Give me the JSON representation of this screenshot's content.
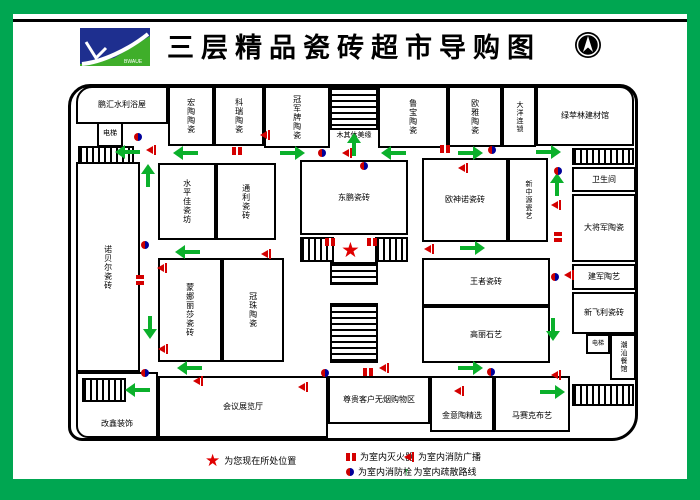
{
  "header": {
    "title": "三层精品瓷砖超市导购图",
    "logo_text": "BWAUE"
  },
  "colors": {
    "frame_green": "#00A651",
    "arrow_green": "#0BB02B",
    "marker_red": "#D40000",
    "hydrant_blue": "#000099",
    "wall_black": "#000000"
  },
  "rooms": {
    "penghui": "鹏汇水利浴屋",
    "elev1": "电梯",
    "t1": "宏陶陶瓷",
    "t2": "科瑞陶瓷",
    "t3": "冠军牌陶瓷",
    "stair_label": "木其休美缘",
    "t4": "鲁宝陶瓷",
    "t5": "欧雅陶瓷",
    "t6": "大洋连锁",
    "t7": "绿苹林建材馆",
    "toilet": "卫生间",
    "r1": "大将军陶瓷",
    "r2": "建军陶艺",
    "r3": "新飞利瓷砖",
    "elev2": "电梯",
    "chaoshan": "潮汕餐馆",
    "left_tall": "诺贝尔瓷砖",
    "m1": "水平佳瓷坊",
    "m2": "通利瓷砖",
    "center": "东鹏瓷砖",
    "rc1": "欧神诺瓷砖",
    "rc2": "新中源瓷艺",
    "bm1": "蒙娜丽莎瓷砖",
    "bm2": "冠珠陶瓷",
    "br1": "王者瓷砖",
    "br2": "高丽石艺",
    "bl": "改鑫装饰",
    "meeting": "会议展览厅",
    "b1": "尊贵客户无烟购物区",
    "b2": "金意陶精选",
    "b3": "马赛克布艺"
  },
  "legend": {
    "location": "为您现在所处位置",
    "extinguisher": "为室内灭火器",
    "hydrant": "为室内消防栓",
    "broadcast": "为室内消防广播",
    "route": "为室内疏散路线"
  },
  "markers": {
    "star": {
      "x": 341,
      "y": 240
    },
    "arrows": [
      {
        "dir": "left",
        "x": 118,
        "y": 150
      },
      {
        "dir": "left",
        "x": 176,
        "y": 151
      },
      {
        "dir": "right",
        "x": 280,
        "y": 151
      },
      {
        "dir": "left",
        "x": 384,
        "y": 151
      },
      {
        "dir": "right",
        "x": 458,
        "y": 151
      },
      {
        "dir": "right",
        "x": 536,
        "y": 150
      },
      {
        "dir": "up",
        "x": 146,
        "y": 167
      },
      {
        "dir": "up",
        "x": 352,
        "y": 136
      },
      {
        "dir": "up",
        "x": 555,
        "y": 176
      },
      {
        "dir": "down",
        "x": 551,
        "y": 318
      },
      {
        "dir": "down",
        "x": 148,
        "y": 316
      },
      {
        "dir": "left",
        "x": 178,
        "y": 250
      },
      {
        "dir": "right",
        "x": 460,
        "y": 246
      },
      {
        "dir": "left",
        "x": 180,
        "y": 366
      },
      {
        "dir": "left",
        "x": 128,
        "y": 388
      },
      {
        "dir": "right",
        "x": 458,
        "y": 366
      },
      {
        "dir": "right",
        "x": 540,
        "y": 390
      }
    ],
    "extinguishers": [
      {
        "x": 232,
        "y": 147,
        "orient": "h"
      },
      {
        "x": 440,
        "y": 145,
        "orient": "h"
      },
      {
        "x": 325,
        "y": 238,
        "orient": "h"
      },
      {
        "x": 367,
        "y": 238,
        "orient": "h"
      },
      {
        "x": 363,
        "y": 368,
        "orient": "h"
      },
      {
        "x": 553,
        "y": 233,
        "orient": "v"
      },
      {
        "x": 135,
        "y": 276,
        "orient": "v"
      }
    ],
    "hydrants": [
      {
        "x": 134,
        "y": 133
      },
      {
        "x": 318,
        "y": 149
      },
      {
        "x": 360,
        "y": 162
      },
      {
        "x": 488,
        "y": 146
      },
      {
        "x": 554,
        "y": 167
      },
      {
        "x": 141,
        "y": 241
      },
      {
        "x": 551,
        "y": 273
      },
      {
        "x": 141,
        "y": 369
      },
      {
        "x": 321,
        "y": 369
      },
      {
        "x": 487,
        "y": 368
      }
    ],
    "speakers": [
      {
        "x": 146,
        "y": 145
      },
      {
        "x": 260,
        "y": 130
      },
      {
        "x": 342,
        "y": 148
      },
      {
        "x": 458,
        "y": 163
      },
      {
        "x": 424,
        "y": 244
      },
      {
        "x": 261,
        "y": 249
      },
      {
        "x": 157,
        "y": 263
      },
      {
        "x": 158,
        "y": 344
      },
      {
        "x": 551,
        "y": 200
      },
      {
        "x": 564,
        "y": 270
      },
      {
        "x": 551,
        "y": 370
      },
      {
        "x": 193,
        "y": 376
      },
      {
        "x": 298,
        "y": 382
      },
      {
        "x": 454,
        "y": 386
      },
      {
        "x": 379,
        "y": 363
      }
    ]
  }
}
